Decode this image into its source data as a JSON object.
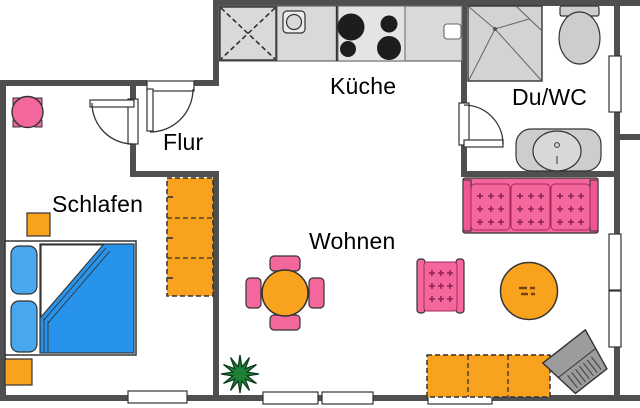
{
  "rooms": {
    "kitchen": {
      "label": "Küche"
    },
    "bathroom": {
      "label": "Du/WC"
    },
    "hallway": {
      "label": "Flur"
    },
    "bedroom": {
      "label": "Schlafen"
    },
    "living": {
      "label": "Wohnen"
    }
  },
  "furniture": [
    "kitchen-counter",
    "fridge-cabinet",
    "kitchen-sink",
    "stove",
    "small-appliance",
    "shower",
    "toilet",
    "bathroom-vanity",
    "entrance-door",
    "bedroom-door",
    "bathroom-door",
    "small-round-table",
    "nightstand-top",
    "nightstand-bottom",
    "double-bed",
    "wardrobe",
    "dining-table",
    "dining-chair",
    "sofa",
    "armchair",
    "coffee-table",
    "sideboard",
    "tv",
    "plant"
  ],
  "colors": {
    "wall": "#4F4F4F",
    "pink": "#F4679D",
    "pink_accent": "#8E2155",
    "orange": "#F9A21D",
    "bed_blue": "#2893EB",
    "pillow_blue": "#49A7EF",
    "fixture_gray": "#CDCDCD",
    "counter_gray": "#D9D9D9",
    "plant_green": "#1E7F37",
    "tv_gray": "#9C9C9C",
    "outline": "#333333"
  }
}
